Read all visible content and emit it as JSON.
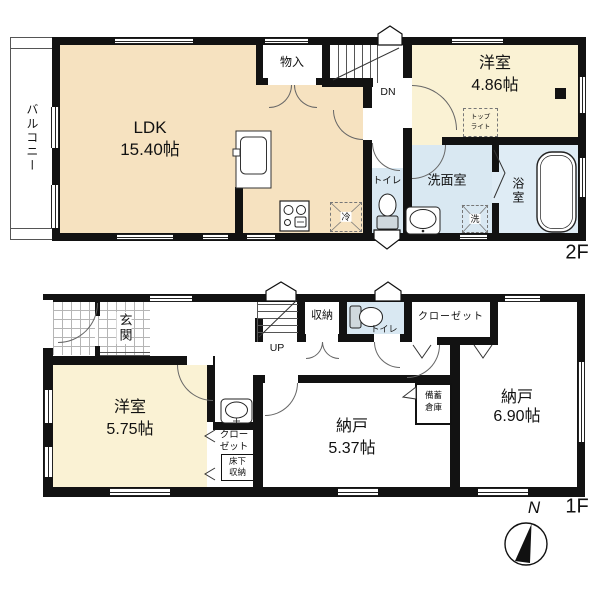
{
  "floor2": {
    "label": "2F",
    "balcony": "バルコニー",
    "ldk": {
      "name": "LDK",
      "size": "15.40帖"
    },
    "storage": "物入",
    "stairs_down": "DN",
    "western_room": {
      "name": "洋室",
      "size": "4.86帖"
    },
    "toplight": {
      "line1": "トップ",
      "line2": "ライト"
    },
    "toilet": "トイレ",
    "washroom": "洗面室",
    "bathroom": "浴室",
    "fridge": "冷",
    "washer": "洗"
  },
  "floor1": {
    "label": "1F",
    "entrance": "玄関",
    "stairs_up": "UP",
    "storage": "収納",
    "toilet": "トイレ",
    "closet": "クローゼット",
    "western_room": {
      "name": "洋室",
      "size": "5.75帖"
    },
    "closet2": {
      "line1": "クロー",
      "line2": "ゼット"
    },
    "underfloor": {
      "line1": "床下",
      "line2": "収納"
    },
    "storeroom_a": {
      "name": "納戸",
      "size": "5.37帖"
    },
    "storeroom_b": {
      "name": "納戸",
      "size": "6.90帖"
    },
    "stockpile": {
      "line1": "備蓄",
      "line2": "倉庫"
    }
  },
  "compass": {
    "north": "N"
  },
  "colors": {
    "room_cream": "#f6e2c0",
    "room_pale": "#faf2d4",
    "room_blue": "#d9e8f2",
    "wall": "#121212"
  }
}
